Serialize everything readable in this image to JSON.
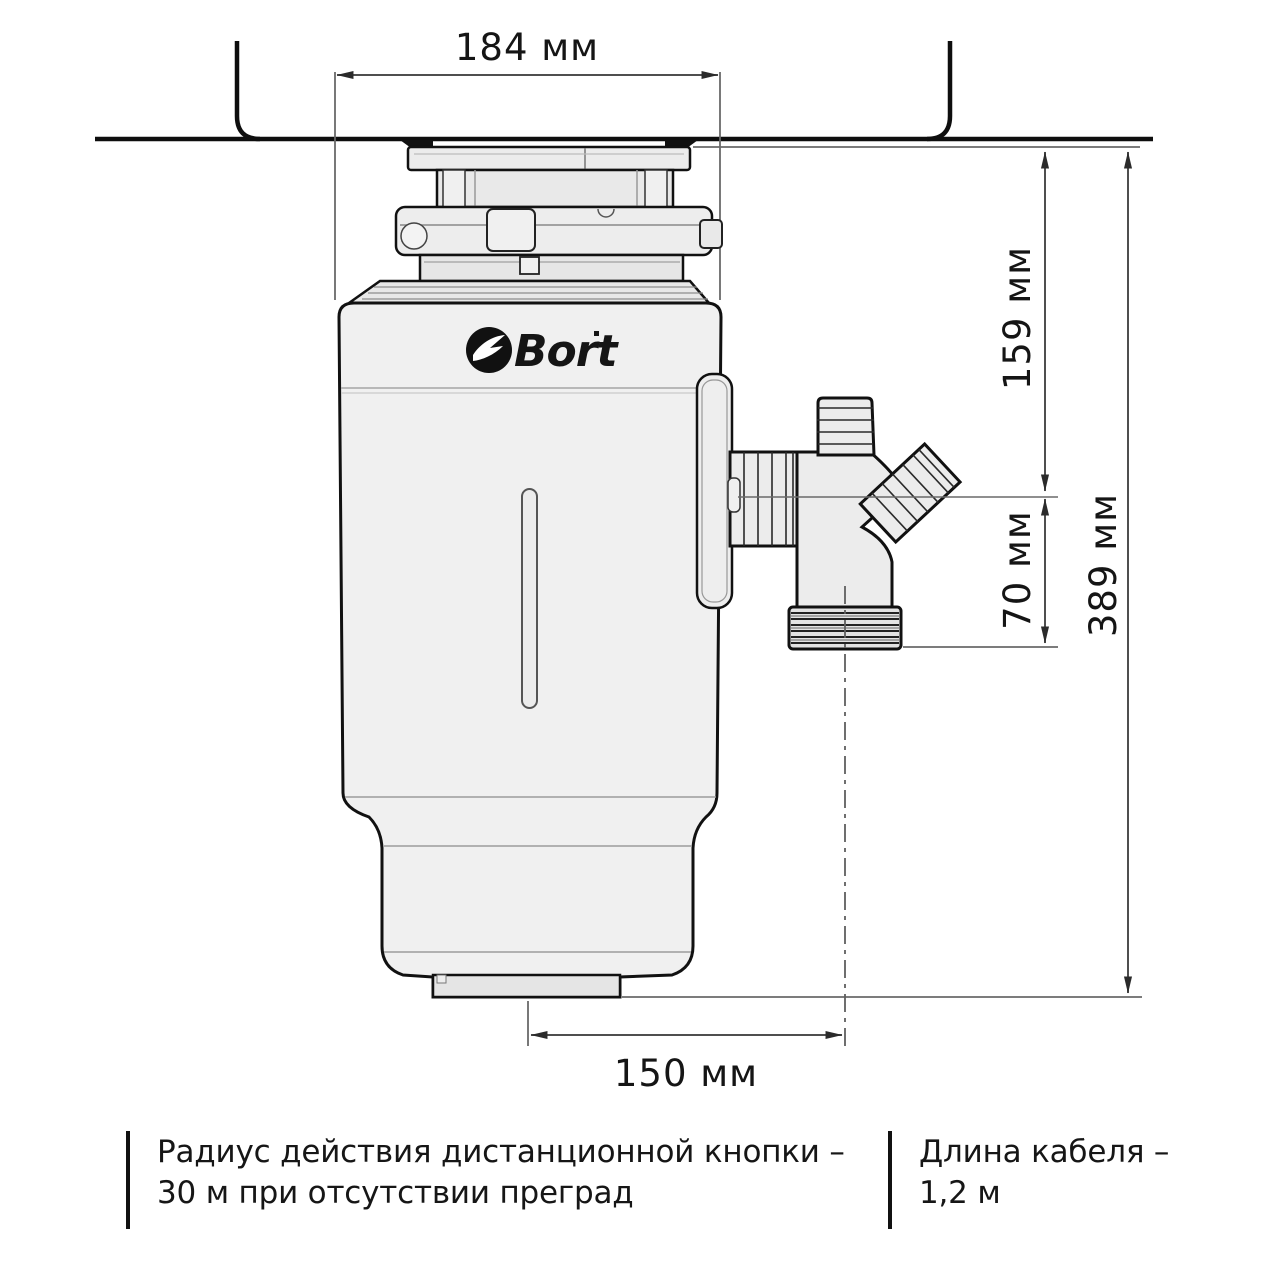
{
  "diagram": {
    "dimensions": {
      "top_width": "184 мм",
      "flange_to_outlet": "159 мм",
      "outlet_drop": "70 мм",
      "total_height": "389 мм",
      "base_offset": "150 мм"
    },
    "brand": {
      "name": "Bort"
    },
    "notes": {
      "remote_line1": "Радиус действия дистанционной кнопки  –",
      "remote_line2": "30 м при отсутствии преград",
      "cable_line1": "Длина кабеля –",
      "cable_line2": "1,2 м"
    },
    "colors": {
      "outline": "#1a1a1a",
      "body_fill": "#efefef",
      "dim_line": "#5f5f5f",
      "logo": "#111111"
    }
  }
}
